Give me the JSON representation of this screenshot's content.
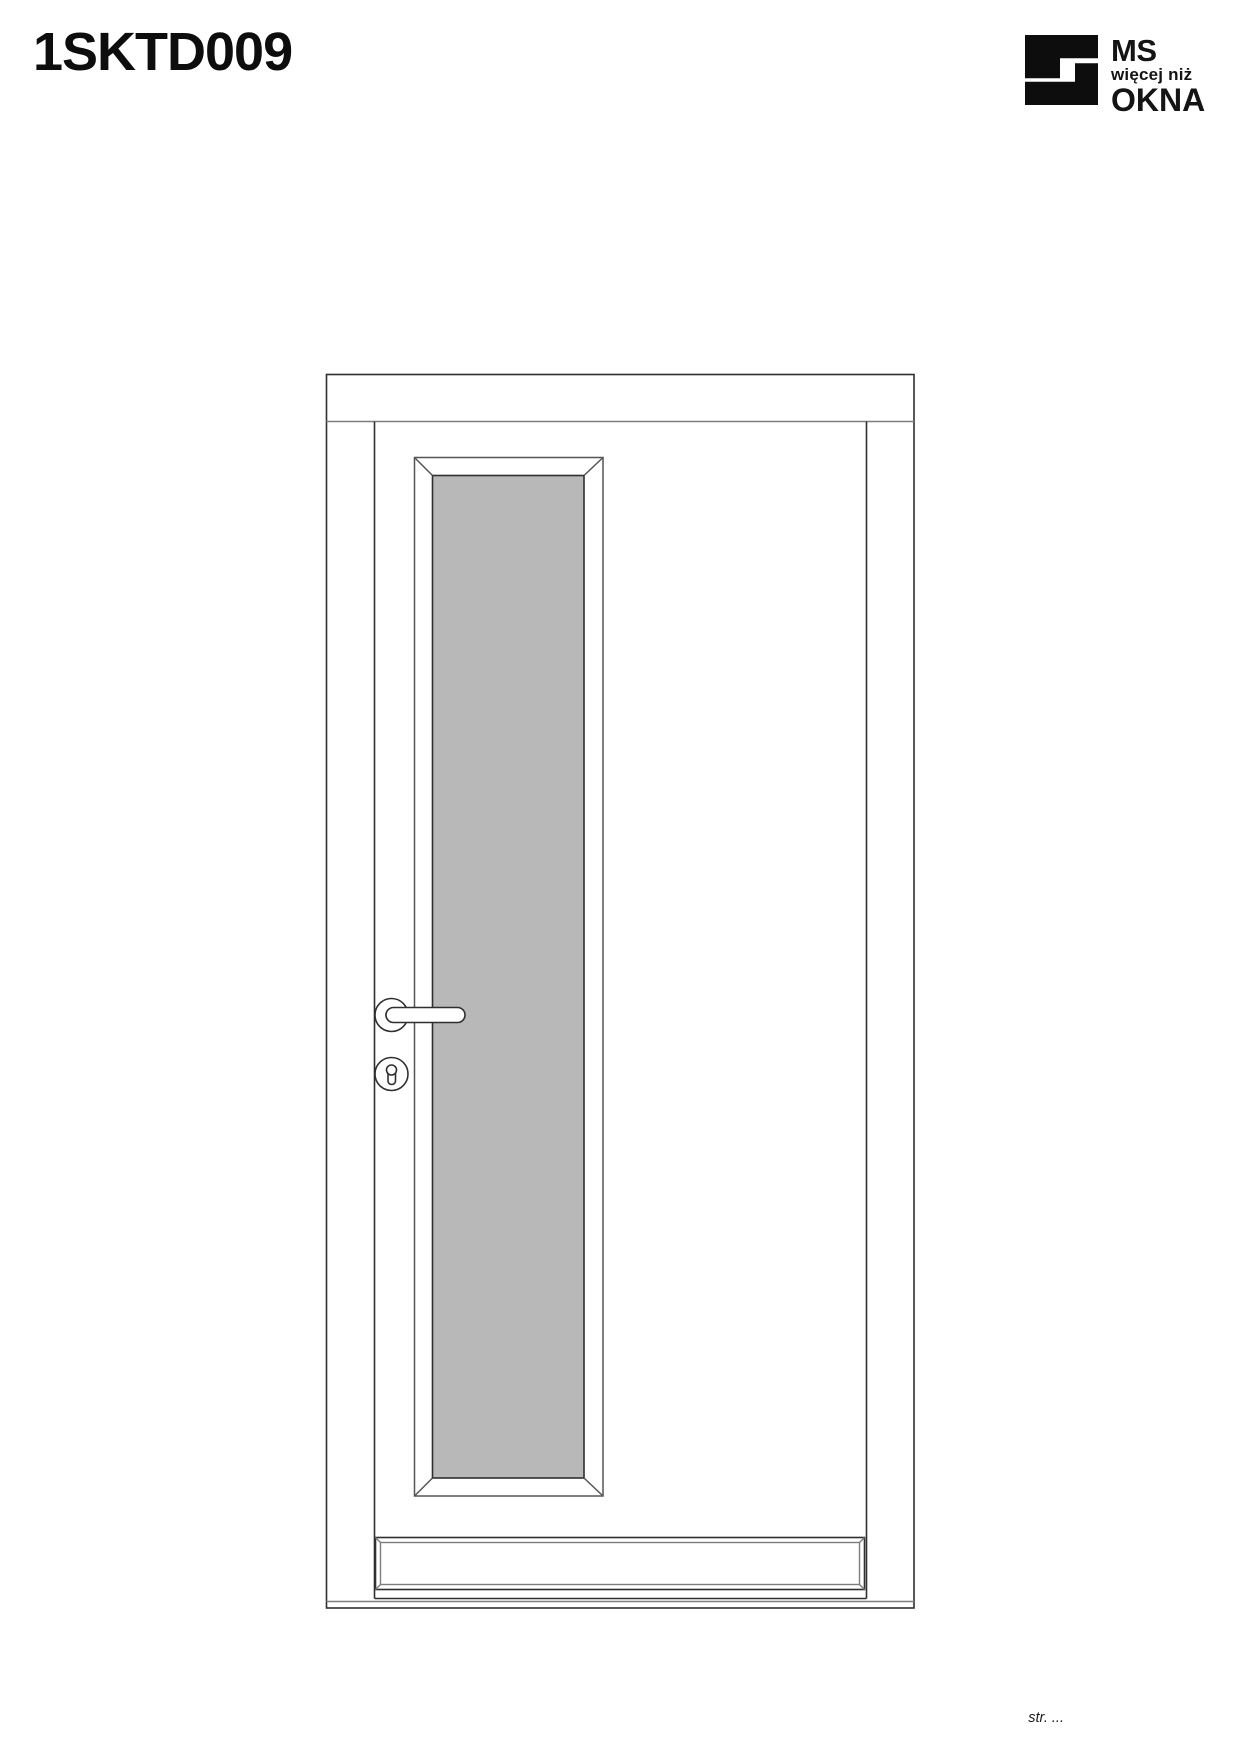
{
  "page": {
    "title": "1SKTD009",
    "footer": "str. ..."
  },
  "logo": {
    "line1": "MS",
    "line2": "więcej niż",
    "line3": "OKNA",
    "color": "#0d0d0d"
  },
  "drawing": {
    "glass_color": "#b8b8b8",
    "line_color": "#2f2f2f",
    "light_line_color": "#7d7d7d"
  }
}
